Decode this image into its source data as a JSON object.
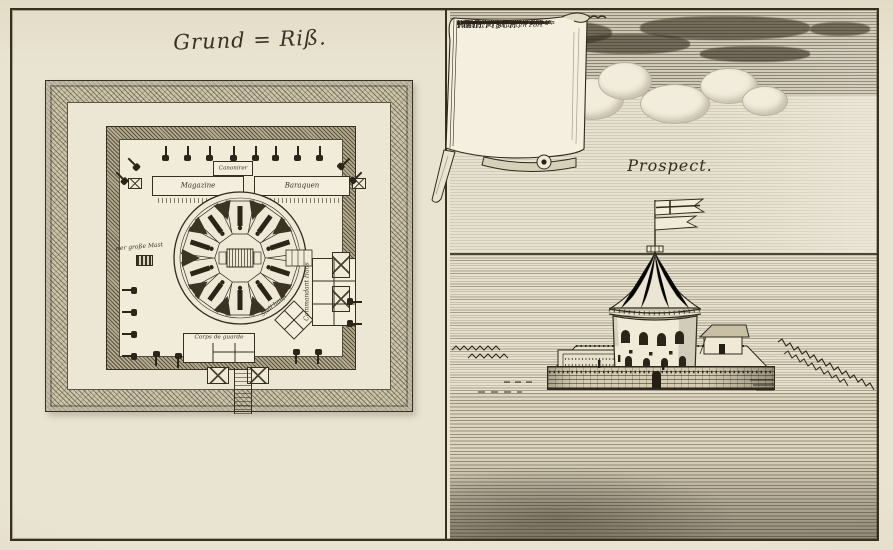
{
  "engraving": {
    "plan_title": "Grund = Riß.",
    "prospect_title": "Prospect.",
    "scroll": {
      "title": "Plan.",
      "subtitle": "Von den so genanten Fort",
      "fort_name": "WALLFISCH.",
      "lines": [
        "a. Das quarré, so exterieur",
        "    ponssirt ist.",
        "b. Der massive Thurn, von unten",
        "    bis oben ponssirt und gewölbet,",
        "    hat 2 Gallerien, c. d.",
        "    auff welcher obersten die Flag-",
        "    ge ausgestecket und die See",
        "    observirt wird, hat zu seiner",
        "    eigenen defension zwey Lagen",
        "    Canons, und ist Bomben frey.",
        "e. Pfahlwerck, so das Eis abhält.",
        "f. Treppe nach den Thurn.",
        "g. Drehen Zug-Brücke.",
        "h. Die brücke und der Eingang."
      ]
    },
    "plan_labels": {
      "canonirer": "Canonirer",
      "magazine": "Magazine",
      "baraquen": "Baraquen",
      "mast": "der große Mast",
      "corps_de_guarde": "Corps de guarde",
      "stall": "Stall hauß",
      "commandant": "Commandant Haus"
    }
  }
}
